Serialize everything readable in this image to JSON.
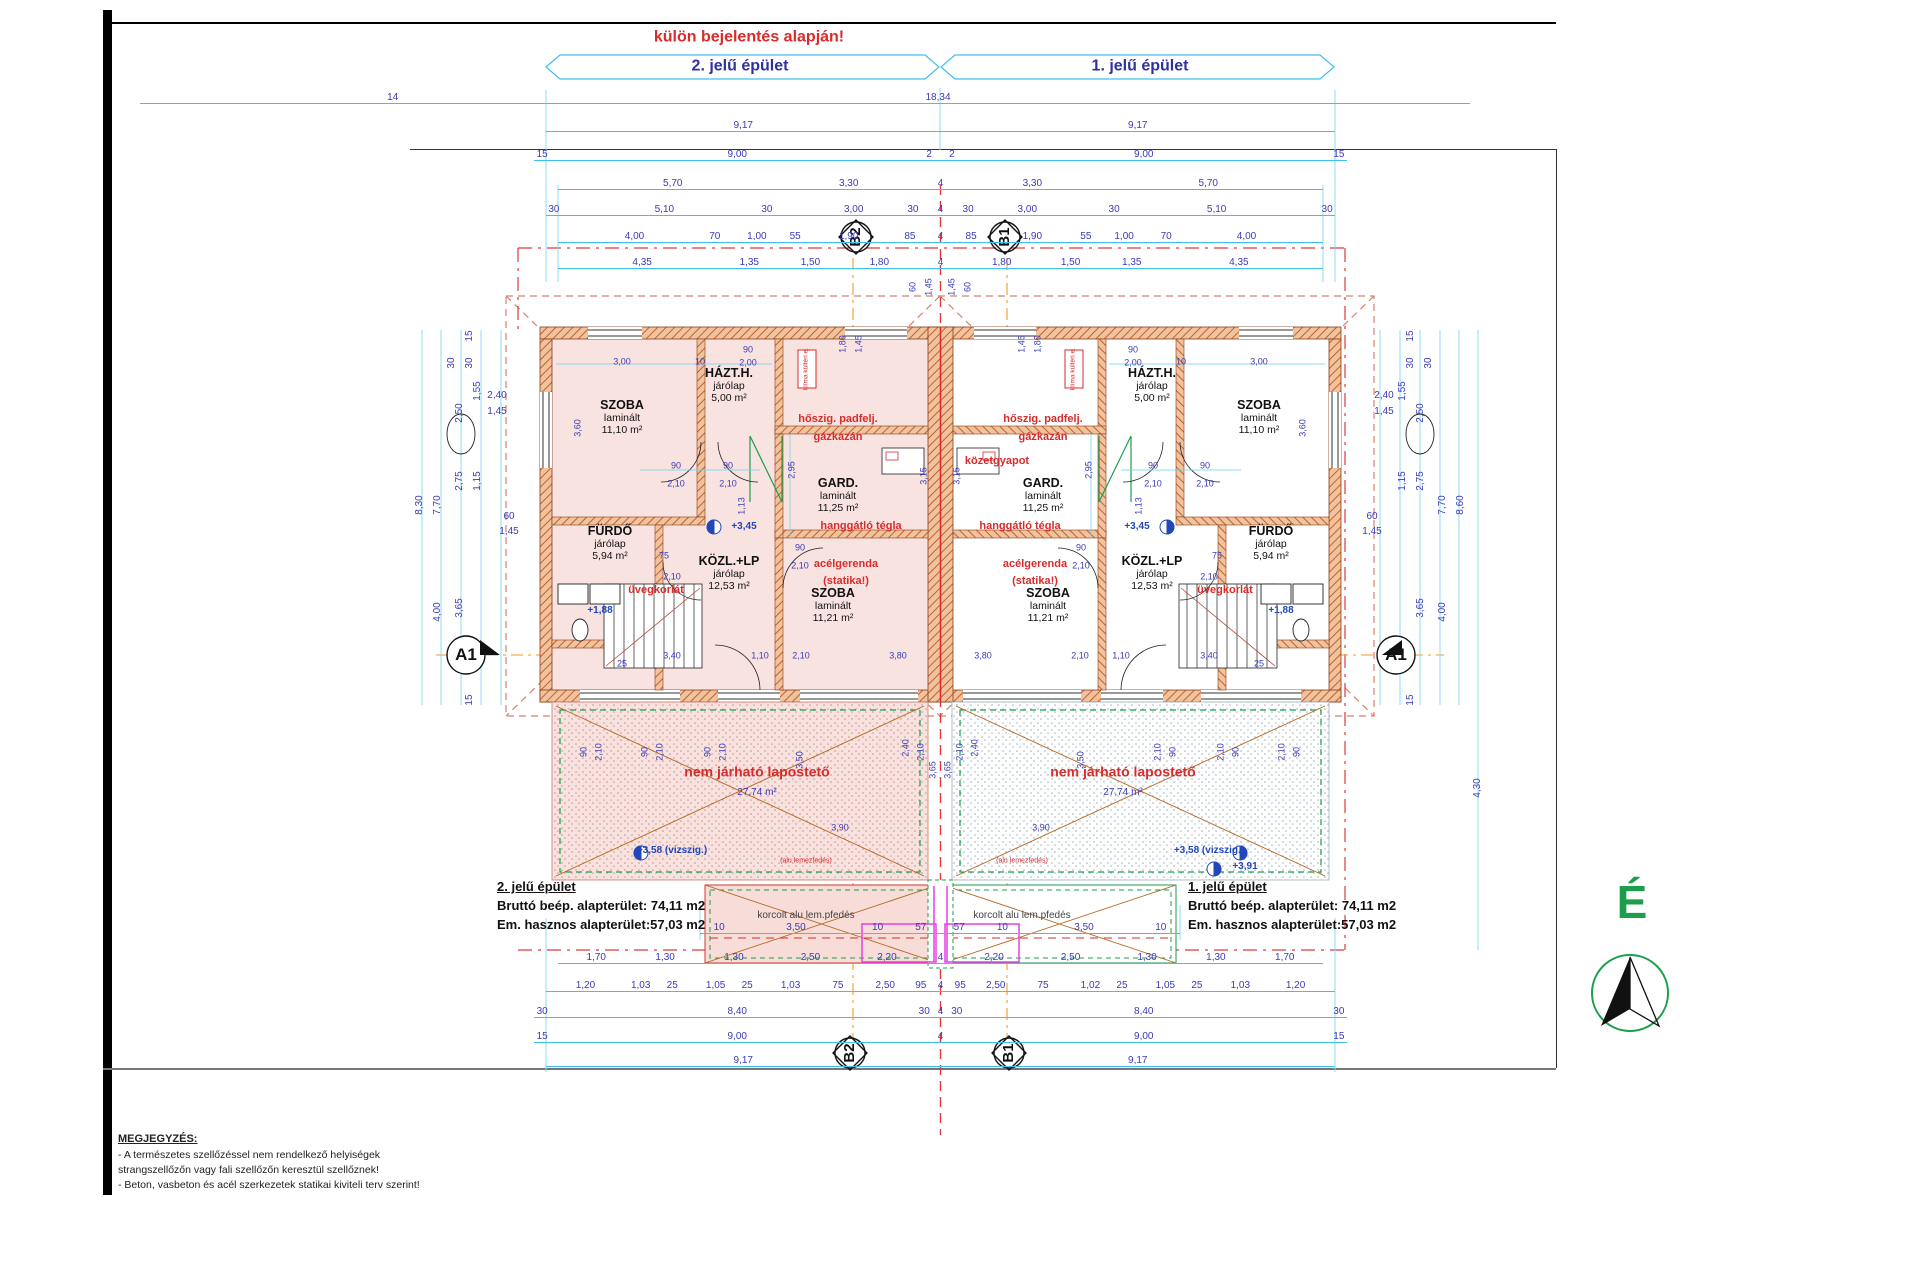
{
  "title_note": "külön bejelentés alapján!",
  "headers": {
    "left": "2. jelű épület",
    "right": "1. jelű épület"
  },
  "north_label": "É",
  "markers": {
    "b2": "B2",
    "b1": "B1",
    "a1": "A1"
  },
  "info_left": {
    "title": "2. jelű épület",
    "line1": "Bruttó beép. alapterület: 74,11 m2",
    "line2": "Em. hasznos alapterület:57,03 m2"
  },
  "info_right": {
    "title": "1. jelű épület",
    "line1": "Bruttó beép. alapterület: 74,11 m2",
    "line2": "Em. hasznos alapterület:57,03 m2"
  },
  "note": {
    "title": "MEGJEGYZÉS:",
    "lines": [
      "- A természetes szellőzéssel nem rendelkező helyiségek",
      "strangszellőzőn vagy fali szellőzőn keresztül szellőznek!",
      "- Beton, vasbeton és acél szerkezetek statikai kiviteli terv szerint!"
    ]
  },
  "flat_roof": {
    "label": "nem járható lapostető",
    "area": "27,74 m²"
  },
  "canopy": {
    "label": "korcolt alu lem.pfedés",
    "sub": "(alu lemezfedés)"
  },
  "klima": "klíma kültéri e.",
  "colors": {
    "dim_line": "#3fc1f0",
    "dim_text": "#3a3ab8",
    "annotation_red": "#d92b2b",
    "header_blue": "#31319e",
    "north_green": "#1c9e4d",
    "wall_orange": "#c0622e",
    "room_pink": "#f9e3e0",
    "magenta": "#e641e6",
    "roof_dashed": "#d4836f",
    "section_orange": "#f59a23"
  },
  "rooms": [
    {
      "name": "SZOBA",
      "finish": "laminált",
      "area": "11,10 m²",
      "x": 622,
      "y": 398
    },
    {
      "name": "HÁZT.H.",
      "finish": "járólap",
      "area": "5,00 m²",
      "x": 729,
      "y": 366
    },
    {
      "name": "GARD.",
      "finish": "laminált",
      "area": "11,25 m²",
      "x": 838,
      "y": 476
    },
    {
      "name": "FÜRDŐ",
      "finish": "járólap",
      "area": "5,94 m²",
      "x": 610,
      "y": 524
    },
    {
      "name": "KÖZL.+LP",
      "finish": "járólap",
      "area": "12,53 m²",
      "x": 729,
      "y": 554
    },
    {
      "name": "SZOBA",
      "finish": "laminált",
      "area": "11,21 m²",
      "x": 833,
      "y": 586
    },
    {
      "name": "SZOBA",
      "finish": "laminált",
      "area": "11,10 m²",
      "x": 1259,
      "y": 398
    },
    {
      "name": "HÁZT.H.",
      "finish": "járólap",
      "area": "5,00 m²",
      "x": 1152,
      "y": 366
    },
    {
      "name": "GARD.",
      "finish": "laminált",
      "area": "11,25 m²",
      "x": 1043,
      "y": 476
    },
    {
      "name": "FÜRDŐ",
      "finish": "járólap",
      "area": "5,94 m²",
      "x": 1271,
      "y": 524
    },
    {
      "name": "KÖZL.+LP",
      "finish": "járólap",
      "area": "12,53 m²",
      "x": 1152,
      "y": 554
    },
    {
      "name": "SZOBA",
      "finish": "laminált",
      "area": "11,21 m²",
      "x": 1048,
      "y": 586
    }
  ],
  "red_annotations": [
    {
      "t": "hőszig. padfelj.",
      "x": 838,
      "y": 420
    },
    {
      "t": "gázkazán",
      "x": 838,
      "y": 438
    },
    {
      "t": "hőszig. padfelj.",
      "x": 1043,
      "y": 420
    },
    {
      "t": "gázkazán",
      "x": 1043,
      "y": 438
    },
    {
      "t": "közetgyapot",
      "x": 997,
      "y": 462
    },
    {
      "t": "hanggátló tégla",
      "x": 861,
      "y": 527
    },
    {
      "t": "hanggátló tégla",
      "x": 1020,
      "y": 527
    },
    {
      "t": "acélgerenda",
      "x": 846,
      "y": 565
    },
    {
      "t": "(statika!)",
      "x": 846,
      "y": 582
    },
    {
      "t": "acélgerenda",
      "x": 1035,
      "y": 565
    },
    {
      "t": "(statika!)",
      "x": 1035,
      "y": 582
    },
    {
      "t": "üvegkorlát",
      "x": 656,
      "y": 591
    },
    {
      "t": "üvegkorlát",
      "x": 1225,
      "y": 591
    }
  ],
  "levels": [
    {
      "t": "+3,45",
      "x": 744,
      "y": 527
    },
    {
      "t": "+3,45",
      "x": 1137,
      "y": 527
    },
    {
      "t": "+1,88",
      "x": 600,
      "y": 611
    },
    {
      "t": "+1,88",
      "x": 1281,
      "y": 611
    },
    {
      "t": "+3,58 (vizszig.)",
      "x": 672,
      "y": 851
    },
    {
      "t": "+3,58 (vizszig.)",
      "x": 1209,
      "y": 851
    },
    {
      "t": "+3,91",
      "x": 1245,
      "y": 867
    }
  ],
  "dim_rows": [
    {
      "y": 103,
      "x1": 140,
      "x2": 1470,
      "labels": [
        {
          "t": "14",
          "p": 19
        },
        {
          "t": "18,34",
          "p": 60
        }
      ]
    },
    {
      "y": 131,
      "x1": 546,
      "x2": 1335,
      "labels": [
        {
          "t": "9,17",
          "p": 25
        },
        {
          "t": "9,17",
          "p": 75
        }
      ]
    },
    {
      "y": 160,
      "x1": 534,
      "x2": 1347,
      "labels": [
        {
          "t": "15",
          "p": 1
        },
        {
          "t": "9,00",
          "p": 25
        },
        {
          "t": "2",
          "p": 48.6
        },
        {
          "t": "2",
          "p": 51.4
        },
        {
          "t": "9,00",
          "p": 75
        },
        {
          "t": "15",
          "p": 99
        }
      ]
    },
    {
      "y": 189,
      "x1": 558,
      "x2": 1323,
      "labels": [
        {
          "t": "5,70",
          "p": 15
        },
        {
          "t": "3,30",
          "p": 38
        },
        {
          "t": "4",
          "p": 50
        },
        {
          "t": "3,30",
          "p": 62
        },
        {
          "t": "5,70",
          "p": 85
        }
      ]
    },
    {
      "y": 215,
      "x1": 546,
      "x2": 1335,
      "labels": [
        {
          "t": "30",
          "p": 1
        },
        {
          "t": "5,10",
          "p": 15
        },
        {
          "t": "30",
          "p": 28
        },
        {
          "t": "3,00",
          "p": 39
        },
        {
          "t": "30",
          "p": 46.5
        },
        {
          "t": "4",
          "p": 50
        },
        {
          "t": "30",
          "p": 53.5
        },
        {
          "t": "3,00",
          "p": 61
        },
        {
          "t": "30",
          "p": 72
        },
        {
          "t": "5,10",
          "p": 85
        },
        {
          "t": "30",
          "p": 99
        }
      ]
    },
    {
      "y": 242,
      "x1": 558,
      "x2": 1323,
      "labels": [
        {
          "t": "4,00",
          "p": 10
        },
        {
          "t": "70",
          "p": 20.5
        },
        {
          "t": "1,00",
          "p": 26
        },
        {
          "t": "55",
          "p": 31
        },
        {
          "t": "1,90",
          "p": 38
        },
        {
          "t": "85",
          "p": 46
        },
        {
          "t": "4",
          "p": 50
        },
        {
          "t": "85",
          "p": 54
        },
        {
          "t": "1,90",
          "p": 62
        },
        {
          "t": "55",
          "p": 69
        },
        {
          "t": "1,00",
          "p": 74
        },
        {
          "t": "70",
          "p": 79.5
        },
        {
          "t": "4,00",
          "p": 90
        }
      ]
    },
    {
      "y": 268,
      "x1": 558,
      "x2": 1323,
      "labels": [
        {
          "t": "4,35",
          "p": 11
        },
        {
          "t": "1,35",
          "p": 25
        },
        {
          "t": "1,50",
          "p": 33
        },
        {
          "t": "1,80",
          "p": 42
        },
        {
          "t": "4",
          "p": 50
        },
        {
          "t": "1,80",
          "p": 58
        },
        {
          "t": "1,50",
          "p": 67
        },
        {
          "t": "1,35",
          "p": 75
        },
        {
          "t": "4,35",
          "p": 89
        }
      ]
    },
    {
      "y": 933,
      "x1": 700,
      "x2": 1180,
      "labels": [
        {
          "t": "10",
          "p": 4
        },
        {
          "t": "3,50",
          "p": 20
        },
        {
          "t": "10",
          "p": 37
        },
        {
          "t": "57",
          "p": 46
        },
        {
          "t": "57",
          "p": 54
        },
        {
          "t": "10",
          "p": 63
        },
        {
          "t": "3,50",
          "p": 80
        },
        {
          "t": "10",
          "p": 96
        }
      ]
    },
    {
      "y": 963,
      "x1": 558,
      "x2": 1323,
      "labels": [
        {
          "t": "1,70",
          "p": 5
        },
        {
          "t": "1,30",
          "p": 14
        },
        {
          "t": "1,30",
          "p": 23
        },
        {
          "t": "2,50",
          "p": 33
        },
        {
          "t": "2,20",
          "p": 43
        },
        {
          "t": "4",
          "p": 50
        },
        {
          "t": "2,20",
          "p": 57
        },
        {
          "t": "2,50",
          "p": 67
        },
        {
          "t": "1,30",
          "p": 77
        },
        {
          "t": "1,30",
          "p": 86
        },
        {
          "t": "1,70",
          "p": 95
        }
      ]
    },
    {
      "y": 991,
      "x1": 546,
      "x2": 1335,
      "labels": [
        {
          "t": "1,20",
          "p": 5
        },
        {
          "t": "1,03",
          "p": 12
        },
        {
          "t": "25",
          "p": 16
        },
        {
          "t": "1,05",
          "p": 21.5
        },
        {
          "t": "25",
          "p": 25.5
        },
        {
          "t": "1,03",
          "p": 31
        },
        {
          "t": "75",
          "p": 37
        },
        {
          "t": "2,50",
          "p": 43
        },
        {
          "t": "95",
          "p": 47.5
        },
        {
          "t": "4",
          "p": 50
        },
        {
          "t": "95",
          "p": 52.5
        },
        {
          "t": "2,50",
          "p": 57
        },
        {
          "t": "75",
          "p": 63
        },
        {
          "t": "1,02",
          "p": 69
        },
        {
          "t": "25",
          "p": 73
        },
        {
          "t": "1,05",
          "p": 78.5
        },
        {
          "t": "25",
          "p": 82.5
        },
        {
          "t": "1,03",
          "p": 88
        },
        {
          "t": "1,20",
          "p": 95
        }
      ]
    },
    {
      "y": 1017,
      "x1": 534,
      "x2": 1347,
      "labels": [
        {
          "t": "30",
          "p": 1
        },
        {
          "t": "8,40",
          "p": 25
        },
        {
          "t": "30",
          "p": 48
        },
        {
          "t": "4",
          "p": 50
        },
        {
          "t": "30",
          "p": 52
        },
        {
          "t": "8,40",
          "p": 75
        },
        {
          "t": "30",
          "p": 99
        }
      ]
    },
    {
      "y": 1042,
      "x1": 534,
      "x2": 1347,
      "labels": [
        {
          "t": "15",
          "p": 1
        },
        {
          "t": "9,00",
          "p": 25
        },
        {
          "t": "4",
          "p": 50
        },
        {
          "t": "9,00",
          "p": 75
        },
        {
          "t": "15",
          "p": 99
        }
      ]
    },
    {
      "y": 1066,
      "x1": 546,
      "x2": 1335,
      "labels": [
        {
          "t": "9,17",
          "p": 25
        },
        {
          "t": "9,17",
          "p": 75
        }
      ]
    }
  ],
  "vertical_dims": [
    {
      "t": "15",
      "x": 470,
      "y": 336,
      "r": 1
    },
    {
      "t": "30",
      "x": 452,
      "y": 363,
      "r": 1
    },
    {
      "t": "30",
      "x": 470,
      "y": 363,
      "r": 1
    },
    {
      "t": "1,55",
      "x": 478,
      "y": 391,
      "r": 1
    },
    {
      "t": "2,50",
      "x": 460,
      "y": 413,
      "r": 1
    },
    {
      "t": "2,40",
      "x": 497,
      "y": 396
    },
    {
      "t": "1,45",
      "x": 497,
      "y": 412
    },
    {
      "t": "2,75",
      "x": 460,
      "y": 481,
      "r": 1
    },
    {
      "t": "1,15",
      "x": 478,
      "y": 481,
      "r": 1
    },
    {
      "t": "7,70",
      "x": 438,
      "y": 505,
      "r": 1
    },
    {
      "t": "8,30",
      "x": 420,
      "y": 505,
      "r": 1
    },
    {
      "t": "60",
      "x": 509,
      "y": 517
    },
    {
      "t": "1,45",
      "x": 509,
      "y": 532
    },
    {
      "t": "3,65",
      "x": 460,
      "y": 608,
      "r": 1
    },
    {
      "t": "4,00",
      "x": 438,
      "y": 612,
      "r": 1
    },
    {
      "t": "15",
      "x": 470,
      "y": 700,
      "r": 1
    },
    {
      "t": "15",
      "x": 1411,
      "y": 336,
      "r": 1
    },
    {
      "t": "30",
      "x": 1429,
      "y": 363,
      "r": 1
    },
    {
      "t": "30",
      "x": 1411,
      "y": 363,
      "r": 1
    },
    {
      "t": "1,55",
      "x": 1403,
      "y": 391,
      "r": 1
    },
    {
      "t": "2,50",
      "x": 1421,
      "y": 413,
      "r": 1
    },
    {
      "t": "2,40",
      "x": 1384,
      "y": 396
    },
    {
      "t": "1,45",
      "x": 1384,
      "y": 412
    },
    {
      "t": "2,75",
      "x": 1421,
      "y": 481,
      "r": 1
    },
    {
      "t": "1,15",
      "x": 1403,
      "y": 481,
      "r": 1
    },
    {
      "t": "7,70",
      "x": 1443,
      "y": 505,
      "r": 1
    },
    {
      "t": "8,60",
      "x": 1461,
      "y": 505,
      "r": 1
    },
    {
      "t": "60",
      "x": 1372,
      "y": 517
    },
    {
      "t": "1,45",
      "x": 1372,
      "y": 532
    },
    {
      "t": "3,65",
      "x": 1421,
      "y": 608,
      "r": 1
    },
    {
      "t": "4,00",
      "x": 1443,
      "y": 612,
      "r": 1
    },
    {
      "t": "15",
      "x": 1411,
      "y": 700,
      "r": 1
    },
    {
      "t": "4,30",
      "x": 1478,
      "y": 788,
      "r": 1
    }
  ],
  "interior_dims": [
    {
      "t": "3,00",
      "x": 622,
      "y": 362
    },
    {
      "t": "10",
      "x": 700,
      "y": 362
    },
    {
      "t": "90",
      "x": 748,
      "y": 350
    },
    {
      "t": "2,00",
      "x": 748,
      "y": 363
    },
    {
      "t": "3,00",
      "x": 1259,
      "y": 362
    },
    {
      "t": "10",
      "x": 1181,
      "y": 362
    },
    {
      "t": "90",
      "x": 1133,
      "y": 350
    },
    {
      "t": "2,00",
      "x": 1133,
      "y": 363
    },
    {
      "t": "60",
      "x": 913,
      "y": 287,
      "r": 1
    },
    {
      "t": "1,45",
      "x": 929,
      "y": 287,
      "r": 1
    },
    {
      "t": "1,45",
      "x": 952,
      "y": 287,
      "r": 1
    },
    {
      "t": "60",
      "x": 968,
      "y": 287,
      "r": 1
    },
    {
      "t": "1,80",
      "x": 843,
      "y": 344,
      "r": 1
    },
    {
      "t": "1,45",
      "x": 859,
      "y": 344,
      "r": 1
    },
    {
      "t": "1,80",
      "x": 1038,
      "y": 344,
      "r": 1
    },
    {
      "t": "1,45",
      "x": 1022,
      "y": 344,
      "r": 1
    },
    {
      "t": "3,60",
      "x": 578,
      "y": 428,
      "r": 1
    },
    {
      "t": "3,60",
      "x": 1303,
      "y": 428,
      "r": 1
    },
    {
      "t": "2,95",
      "x": 792,
      "y": 470,
      "r": 1
    },
    {
      "t": "2,95",
      "x": 1089,
      "y": 470,
      "r": 1
    },
    {
      "t": "3,15",
      "x": 924,
      "y": 476,
      "r": 1
    },
    {
      "t": "3,15",
      "x": 957,
      "y": 476,
      "r": 1
    },
    {
      "t": "90",
      "x": 676,
      "y": 466
    },
    {
      "t": "2,10",
      "x": 676,
      "y": 484
    },
    {
      "t": "90",
      "x": 728,
      "y": 466
    },
    {
      "t": "2,10",
      "x": 728,
      "y": 484
    },
    {
      "t": "90",
      "x": 1153,
      "y": 466
    },
    {
      "t": "2,10",
      "x": 1153,
      "y": 484
    },
    {
      "t": "90",
      "x": 1205,
      "y": 466
    },
    {
      "t": "2,10",
      "x": 1205,
      "y": 484
    },
    {
      "t": "90",
      "x": 800,
      "y": 548
    },
    {
      "t": "2,10",
      "x": 800,
      "y": 566
    },
    {
      "t": "90",
      "x": 1081,
      "y": 548
    },
    {
      "t": "2,10",
      "x": 1081,
      "y": 566
    },
    {
      "t": "75",
      "x": 664,
      "y": 556
    },
    {
      "t": "2,10",
      "x": 672,
      "y": 577
    },
    {
      "t": "75",
      "x": 1217,
      "y": 556
    },
    {
      "t": "2,10",
      "x": 1209,
      "y": 577
    },
    {
      "t": "1,13",
      "x": 742,
      "y": 506,
      "r": 1
    },
    {
      "t": "1,13",
      "x": 1139,
      "y": 506,
      "r": 1
    },
    {
      "t": "3,40",
      "x": 672,
      "y": 656
    },
    {
      "t": "1,10",
      "x": 760,
      "y": 656
    },
    {
      "t": "2,10",
      "x": 801,
      "y": 656
    },
    {
      "t": "3,80",
      "x": 898,
      "y": 656
    },
    {
      "t": "3,80",
      "x": 983,
      "y": 656
    },
    {
      "t": "2,10",
      "x": 1080,
      "y": 656
    },
    {
      "t": "1,10",
      "x": 1121,
      "y": 656
    },
    {
      "t": "3,40",
      "x": 1209,
      "y": 656
    },
    {
      "t": "25",
      "x": 622,
      "y": 664
    },
    {
      "t": "25",
      "x": 1259,
      "y": 664
    },
    {
      "t": "90",
      "x": 584,
      "y": 752,
      "r": 1
    },
    {
      "t": "2,10",
      "x": 599,
      "y": 752,
      "r": 1
    },
    {
      "t": "90",
      "x": 645,
      "y": 752,
      "r": 1
    },
    {
      "t": "2,10",
      "x": 660,
      "y": 752,
      "r": 1
    },
    {
      "t": "90",
      "x": 708,
      "y": 752,
      "r": 1
    },
    {
      "t": "2,10",
      "x": 723,
      "y": 752,
      "r": 1
    },
    {
      "t": "3,50",
      "x": 800,
      "y": 760,
      "r": 1
    },
    {
      "t": "2,40",
      "x": 906,
      "y": 748,
      "r": 1
    },
    {
      "t": "2,10",
      "x": 921,
      "y": 752,
      "r": 1
    },
    {
      "t": "90",
      "x": 1297,
      "y": 752,
      "r": 1
    },
    {
      "t": "2,10",
      "x": 1282,
      "y": 752,
      "r": 1
    },
    {
      "t": "90",
      "x": 1236,
      "y": 752,
      "r": 1
    },
    {
      "t": "2,10",
      "x": 1221,
      "y": 752,
      "r": 1
    },
    {
      "t": "90",
      "x": 1173,
      "y": 752,
      "r": 1
    },
    {
      "t": "2,10",
      "x": 1158,
      "y": 752,
      "r": 1
    },
    {
      "t": "3,50",
      "x": 1081,
      "y": 760,
      "r": 1
    },
    {
      "t": "2,40",
      "x": 975,
      "y": 748,
      "r": 1
    },
    {
      "t": "2,10",
      "x": 960,
      "y": 752,
      "r": 1
    },
    {
      "t": "3,65",
      "x": 933,
      "y": 770,
      "r": 1
    },
    {
      "t": "3,65",
      "x": 948,
      "y": 770,
      "r": 1
    },
    {
      "t": "3,90",
      "x": 840,
      "y": 828
    },
    {
      "t": "3,90",
      "x": 1041,
      "y": 828
    }
  ]
}
